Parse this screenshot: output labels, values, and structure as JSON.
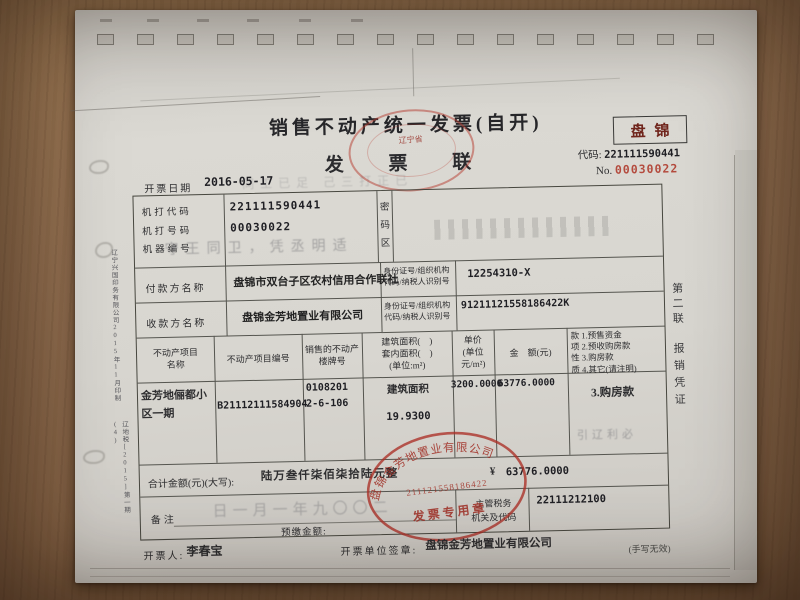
{
  "header": {
    "title": "销售不动产统一发票(自开)",
    "copy_name": "发  票  联",
    "region_box": "盘锦",
    "code_label": "代码:",
    "code_value": "221111590441",
    "no_label": "No.",
    "no_value": "00030022",
    "date_label": "开票日期",
    "date_value": "2016-05-17",
    "oversight_stamp_text": "辽宁省"
  },
  "machine_info": {
    "row_labels": "机打代码\n机打号码\n机器编号",
    "printed_code": "221111590441",
    "printed_number": "00030022",
    "password_zone_label": "密\n码\n区"
  },
  "parties": {
    "payer_label": "付款方名称",
    "payer_name": "盘锦市双台子区农村信用合作联社",
    "payer_id": "12254310-X",
    "payee_label": "收款方名称",
    "payee_name": "盘锦金芳地置业有限公司",
    "payee_id": "91211121558186422K",
    "id_label": "身份证号/组织机构\n代码/纳税人识别号"
  },
  "items_table": {
    "col_project_name": "不动产项目\n名称",
    "col_project_no": "不动产项目编号",
    "col_building_no": "销售的不动产\n楼牌号",
    "col_area": "建筑面积(　)\n套内面积(　)\n(单位:m²)",
    "col_unit_price": "单价\n(单位\n元/m²)",
    "col_amount": "金　额(元)",
    "col_payment_nature": "款 1.预售资金\n项 2.预收购房款\n性 3.购房款\n质 4.其它(请注明)",
    "row": {
      "project_name": "金芳地俪都小\n区一期",
      "project_no": "B21112111584904",
      "building_no": "0108201\n2-6-106",
      "area_type": "建筑面积",
      "area_value": "19.9300",
      "unit_price": "3200.0000",
      "amount": "63776.0000",
      "payment_nature": "3.购房款"
    }
  },
  "total": {
    "label": "合计金额(元)(大写):",
    "amount_words": "陆万叁仟柒佰柒拾陆元整",
    "currency_symbol": "¥",
    "amount_figures": "63776.0000"
  },
  "remark": {
    "label": "备注",
    "prepaid_label": "预缴金额:",
    "tax_authority_label": "主管税务\n机关及代码",
    "tax_authority_code": "22111212100"
  },
  "footer": {
    "drawer_label": "开票人:",
    "drawer_name": "李春宝",
    "issuer_label": "开票单位签章:",
    "issuer_name": "盘锦金芳地置业有限公司",
    "handwriting_note": "(手写无效)"
  },
  "seal": {
    "company": "盘锦金芳地置业有限公司",
    "number": "211121558186422",
    "caption": "发票专用章"
  },
  "margins": {
    "copy_no": "第二联",
    "copy_use": "报销凭证",
    "printer_info": "辽宁兴国印务有限公司2015年11月印制",
    "print_approval": "辽地税[2015]第一期(4)"
  },
  "ghosts": {
    "header_row": "同工已足 己三打正已",
    "machine_row": "守王同卫，凭丞明适",
    "remark_date": "日一月一年九〇〇二",
    "under_payment": "引辽利必"
  }
}
